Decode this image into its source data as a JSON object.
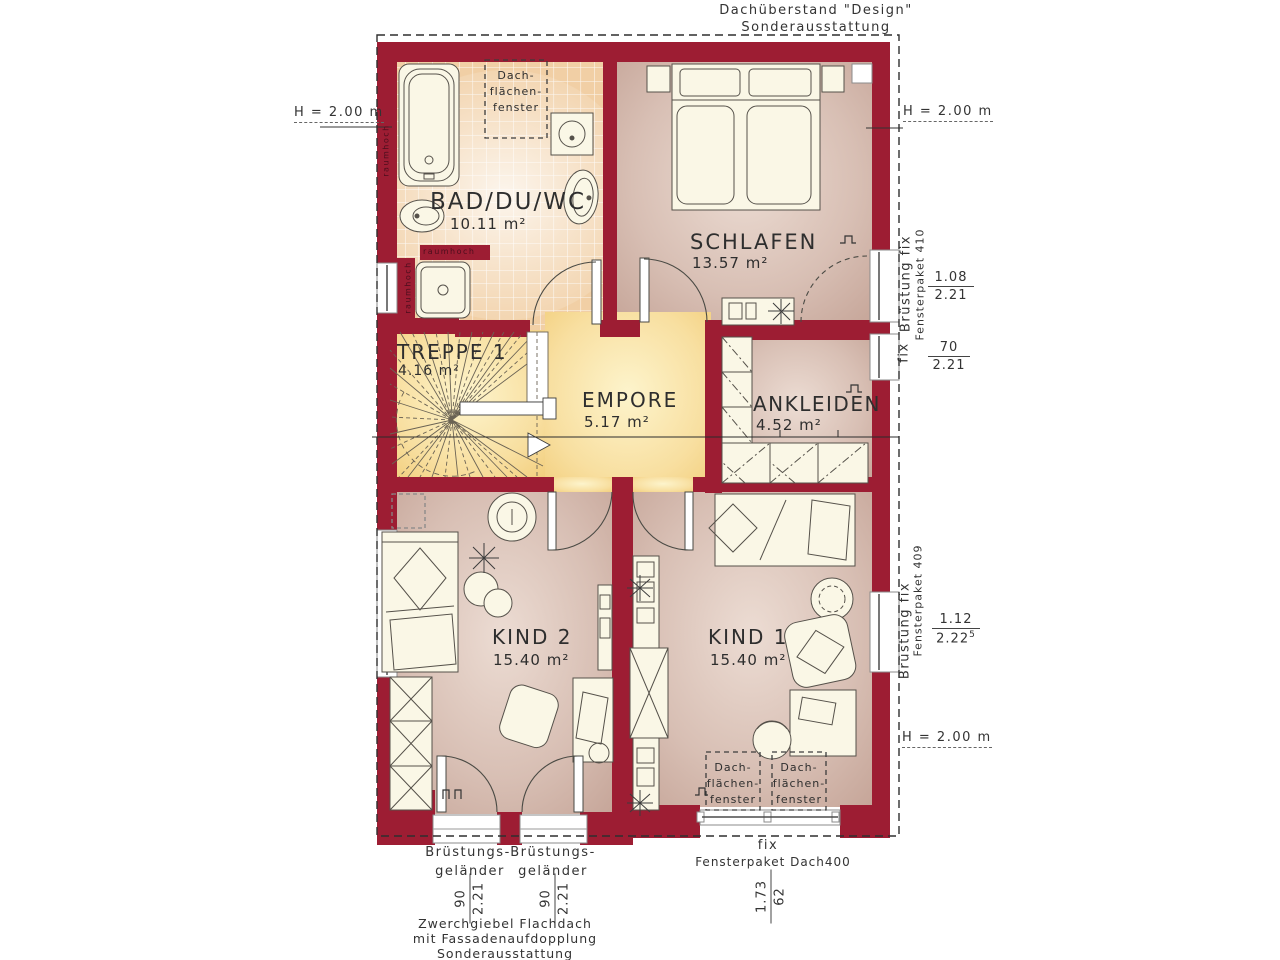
{
  "colors": {
    "wall": "#9d1d33",
    "tile": "#f1cfa5",
    "tile_light": "#fbe9d4",
    "yellow": "#f1cb76",
    "yellow_light": "#fdf4cc",
    "mauve": "#c2a093",
    "mauve_light": "#ecdcd3",
    "furniture": "#faf7e6",
    "line": "#55514a",
    "text": "#383838"
  },
  "annotations": {
    "roof_overhang_line1": "Dachüberstand \"Design\"",
    "roof_overhang_line2": "Sonderausstattung",
    "h_left": "H = 2.00 m",
    "h_right_top": "H = 2.00 m",
    "h_right_bottom": "H = 2.00 m",
    "zwerchgiebel_line1": "Zwerchgiebel Flachdach",
    "zwerchgiebel_line2": "mit Fassadenaufdopplung",
    "zwerchgiebel_line3": "Sonderausstattung",
    "raumhoch": "raumhoch"
  },
  "rooms": {
    "bad": {
      "name": "BAD/DU/WC",
      "area": "10.11 m²"
    },
    "schlafen": {
      "name": "SCHLAFEN",
      "area": "13.57 m²"
    },
    "treppe": {
      "name": "TREPPE 1",
      "area": "4.16 m²"
    },
    "empore": {
      "name": "EMPORE",
      "area": "5.17 m²"
    },
    "ankleiden": {
      "name": "ANKLEIDEN",
      "area": "4.52 m²"
    },
    "kind2": {
      "name": "KIND 2",
      "area": "15.40 m²"
    },
    "kind1": {
      "name": "KIND 1",
      "area": "15.40 m²"
    }
  },
  "roof_window_label": {
    "line1": "Dach-",
    "line2": "flächen-",
    "line3": "fenster"
  },
  "windows": {
    "paket410": {
      "label": "Brüstung fix",
      "product": "Fensterpaket 410",
      "width": "1.08",
      "height": "2.21",
      "fix": "fix",
      "width2": "70",
      "height2": "2.21"
    },
    "paket409": {
      "label": "Brüstung fix",
      "product": "Fensterpaket 409",
      "width": "1.12",
      "height": "2.22",
      "height_sup": "5"
    },
    "dach400": {
      "fix": "fix",
      "product": "Fensterpaket Dach400",
      "width": "1.73",
      "height": "62"
    },
    "railing": {
      "line1": "Brüstungs-",
      "line2": "geländer",
      "width": "90",
      "height": "2.21"
    }
  }
}
